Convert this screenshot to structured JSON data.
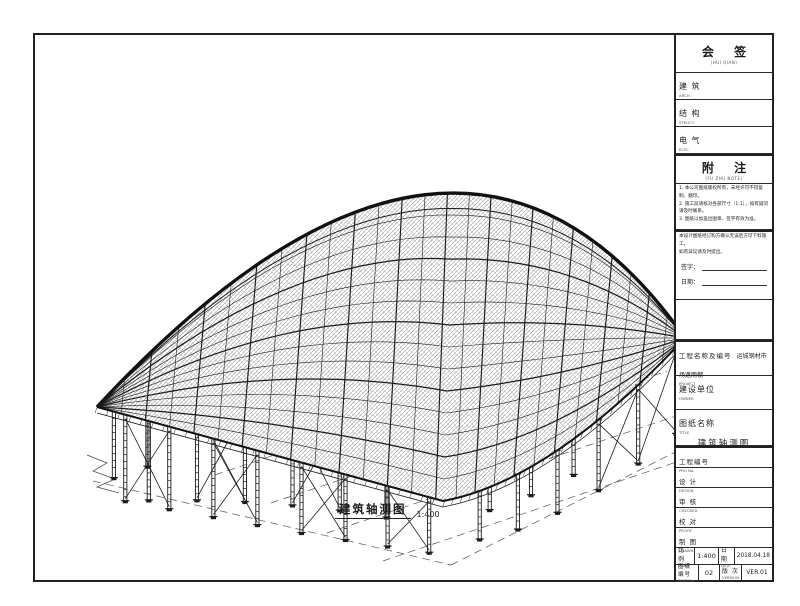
{
  "title_block": {
    "huiqian": {
      "title": "会 签",
      "sub": "(HUI QIAN)"
    },
    "disciplines": [
      {
        "label": "建 筑",
        "sub": "ARCH."
      },
      {
        "label": "结 构",
        "sub": "STRUCT."
      },
      {
        "label": "电 气",
        "sub": "ELEC."
      }
    ],
    "fuzhu": {
      "title": "附 注",
      "sub": "(FU ZHU NOTE)"
    },
    "notes": [
      "1. 本公司图纸版权所有，未经许可不得复制、翻印。",
      "2. 施工前请核对各部尺寸（1:1），如有疑问请及时联系。",
      "3. 图纸以加盖出图章、签字有效为准。"
    ],
    "confirm": {
      "lines": [
        "本设计图纸经订购方确认无误后方可下料施工，",
        "如有异议请及时提出。"
      ],
      "sign_label": "签字：",
      "date_label": "日期："
    },
    "project": {
      "label": "工程名称及编号",
      "sub": "PROJECT",
      "value": "运城钢材市场遮雨棚"
    },
    "owner": {
      "label": "建设单位",
      "sub": "OWNER",
      "value": ""
    },
    "dwg_title": {
      "label": "图纸名称",
      "sub": "TITLE",
      "value": "建筑轴测图"
    },
    "project_no": {
      "label": "工程编号",
      "sub": "PRO No.",
      "value": ""
    },
    "sign_rows": [
      {
        "label": "设 计",
        "sub": "DESIGN"
      },
      {
        "label": "审 核",
        "sub": "CHECKED"
      },
      {
        "label": "校 对",
        "sub": "PROOF"
      },
      {
        "label": "制 图",
        "sub": "DRAWN"
      }
    ],
    "scale": {
      "label": "比 例",
      "sub": "SCALE",
      "value": "1:400"
    },
    "date": {
      "label": "日 期",
      "sub": "DATE",
      "value": "2018.04.18"
    },
    "dwg_no": {
      "label": "图纸编号",
      "sub": "DWG No.",
      "value": "02"
    },
    "version": {
      "label": "版 次",
      "sub": "VERSION",
      "value": "VER.01"
    }
  },
  "caption": {
    "text": "建筑轴测图",
    "scale": "1:400"
  },
  "drawing": {
    "stroke": "#1c1c1c",
    "W": [
      97,
      407
    ],
    "S": [
      443,
      501
    ],
    "E": [
      685,
      338
    ],
    "arc_ctrl": [
      459,
      17
    ],
    "right_ctrl": [
      551,
      481
    ],
    "split": 0.55,
    "ribs": 26,
    "bands": 14,
    "rows": [
      {
        "name": "left-back",
        "v": 0.5,
        "u": [
          0.025,
          0.075
        ],
        "h": [
          78,
          80
        ],
        "braces": []
      },
      {
        "name": "middle",
        "v": 0.78,
        "u": [
          0.08,
          0.155,
          0.23,
          0.305,
          0.38,
          0.455
        ],
        "h": [
          95,
          95,
          95,
          95,
          95,
          95
        ],
        "braces": [
          [
            1,
            2
          ],
          [
            3,
            4
          ]
        ]
      },
      {
        "name": "inner-right",
        "v": 0.86,
        "u": [
          0.64,
          0.72,
          0.8
        ],
        "h": [
          62,
          62,
          62
        ],
        "braces": []
      },
      {
        "name": "front",
        "v": 1.0,
        "u": [
          0.045,
          0.115,
          0.185,
          0.255,
          0.325,
          0.395,
          0.462,
          0.528
        ],
        "h": [
          86,
          82,
          78,
          74,
          70,
          65,
          60,
          55
        ],
        "braces": [
          [
            0,
            1
          ],
          [
            2,
            3
          ],
          [
            4,
            5
          ],
          [
            6,
            7
          ]
        ]
      },
      {
        "name": "right",
        "v": 1.0,
        "u": [
          0.625,
          0.7,
          0.775,
          0.85,
          0.92,
          0.985
        ],
        "h": [
          48,
          55,
          62,
          70,
          78,
          86
        ],
        "braces": [
          [
            3,
            4
          ],
          [
            4,
            5
          ]
        ]
      }
    ],
    "ground": {
      "dashes": [
        [
          93,
          481,
          451,
          565
        ],
        [
          451,
          565,
          725,
          427
        ],
        [
          271,
          503,
          667,
          371
        ],
        [
          327,
          533,
          691,
          411
        ],
        [
          383,
          561,
          709,
          451
        ],
        [
          215,
          475,
          595,
          347
        ]
      ],
      "zigzag_left": [
        [
          87,
          455
        ],
        [
          107,
          463
        ],
        [
          93,
          471
        ],
        [
          115,
          479
        ],
        [
          97,
          487
        ],
        [
          119,
          493
        ]
      ],
      "zigzag_right": [
        [
          703,
          433
        ],
        [
          723,
          425
        ],
        [
          711,
          417
        ],
        [
          731,
          409
        ],
        [
          717,
          401
        ]
      ]
    }
  }
}
